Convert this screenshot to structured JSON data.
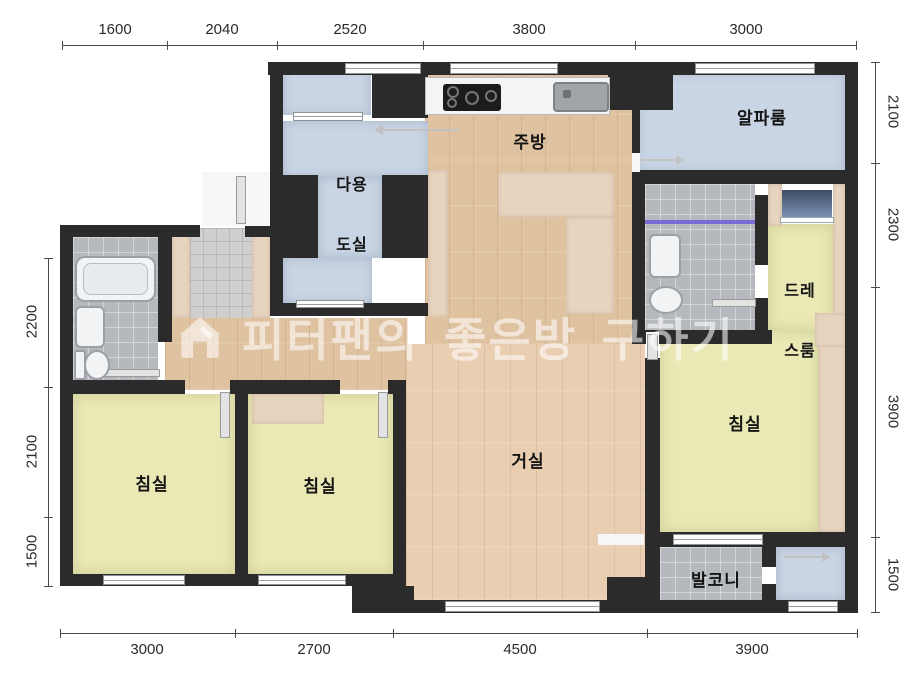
{
  "watermark": {
    "text": "피터팬의 좋은방 구하기",
    "icon": "house-icon"
  },
  "rooms": {
    "utility": {
      "line1": "다용",
      "line2": "도실"
    },
    "kitchen": {
      "label": "주방"
    },
    "alpha_room": {
      "label": "알파룸"
    },
    "dress_room": {
      "line1": "드레",
      "line2": "스룸"
    },
    "living_room": {
      "label": "거실"
    },
    "bedroom_left": {
      "label": "침실"
    },
    "bedroom_center": {
      "label": "침실"
    },
    "bedroom_right": {
      "label": "침실"
    },
    "balcony": {
      "label": "발코니"
    }
  },
  "dimensions": {
    "top": [
      "1600",
      "2040",
      "2520",
      "3800",
      "3000"
    ],
    "bottom": [
      "3000",
      "2700",
      "4500",
      "3900"
    ],
    "left": [
      "2200",
      "2100",
      "1500"
    ],
    "right": [
      "2100",
      "2300",
      "3900",
      "1500"
    ]
  },
  "colors": {
    "wall": "#2b2b2b",
    "wood": "#dfc2a0",
    "wood_light": "#e9ceb2",
    "floor_yellow": "#eae9b5",
    "floor_blue": "#c9d5e4",
    "furniture_tan": "#e7d4bf",
    "tile_gray": "#b5b8bc",
    "shower_line": "#7a6bd6"
  }
}
